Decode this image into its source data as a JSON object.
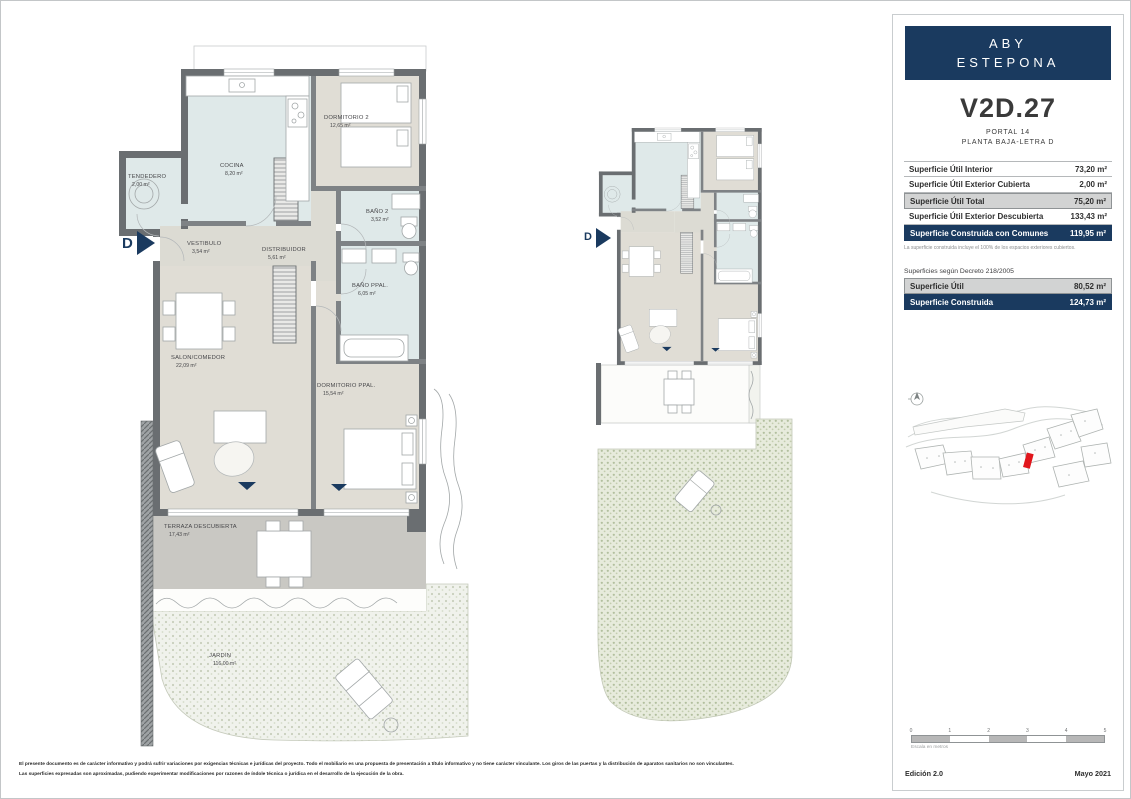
{
  "page": {
    "disclaimer_line1": "El presente documento es de carácter informativo y podrá sufrir variaciones por exigencias técnicas e jurídicas del proyecto. Todo el mobiliario es una propuesta de presentación a título informativo y no tiene carácter vinculante. Los giros de las puertas y la distribución de aparatos sanitarios no son vinculantes.",
    "disclaimer_line2": "Las superficies expresadas son aproximadas, pudiendo experimentar modificaciones por razones de índole técnica o jurídica en el desarrollo de la ejecución de la obra."
  },
  "panel": {
    "brand_line1": "ABY",
    "brand_line2": "ESTEPONA",
    "unit_code": "V2D.27",
    "portal": "PORTAL 14",
    "floor": "PLANTA BAJA-LETRA D",
    "surfaces": {
      "rows": [
        {
          "label": "Superficie Útil Interior",
          "value": "73,20 m²"
        },
        {
          "label": "Superficie Útil Exterior Cubierta",
          "value": "2,00 m²"
        },
        {
          "label": "Superficie Útil Total",
          "value": "75,20 m²"
        },
        {
          "label": "Superficie Útil Exterior Descubierta",
          "value": "133,43 m²"
        },
        {
          "label": "Superficie Construida con Comunes",
          "value": "119,95 m²"
        }
      ],
      "note": "La superficie construida incluye el 100% de los espacios exteriores cubiertos."
    },
    "decreto": {
      "title": "Superficies según Decreto 218/2005",
      "rows": [
        {
          "label": "Superficie Útil",
          "value": "80,52 m²"
        },
        {
          "label": "Superficie Construida",
          "value": "124,73 m²"
        }
      ]
    },
    "scalebar": {
      "ticks": [
        "0",
        "1",
        "2",
        "3",
        "4",
        "5"
      ],
      "caption": "Escala en metros"
    },
    "edition": "Edición 2.0",
    "date": "Mayo 2021"
  },
  "floorplan": {
    "entrance_letter": "D",
    "rooms": [
      {
        "name": "TENDEDERO",
        "area": "2,00 m²"
      },
      {
        "name": "COCINA",
        "area": "8,20 m²"
      },
      {
        "name": "DORMITORIO 2",
        "area": "12,65 m²"
      },
      {
        "name": "BAÑO 2",
        "area": "3,52 m²"
      },
      {
        "name": "VESTIBULO",
        "area": "3,54 m²"
      },
      {
        "name": "DISTRIBUIDOR",
        "area": "5,61 m²"
      },
      {
        "name": "BAÑO PPAL.",
        "area": "6,05 m²"
      },
      {
        "name": "SALON/COMEDOR",
        "area": "22,09 m²"
      },
      {
        "name": "DORMITORIO PPAL.",
        "area": "15,54 m²"
      },
      {
        "name": "TERRAZA DESCUBIERTA",
        "area": "17,43 m²"
      },
      {
        "name": "JARDIN",
        "area": "116,00 m²"
      }
    ]
  },
  "colors": {
    "navy": "#1a3a5f",
    "unit_marker_red": "#e1161c",
    "wall_gray": "#6a6e71",
    "wet_room_floor": "#dfe9e9",
    "dry_room_floor": "#e0ddd5",
    "terrace_gray": "#c9c8c3"
  }
}
